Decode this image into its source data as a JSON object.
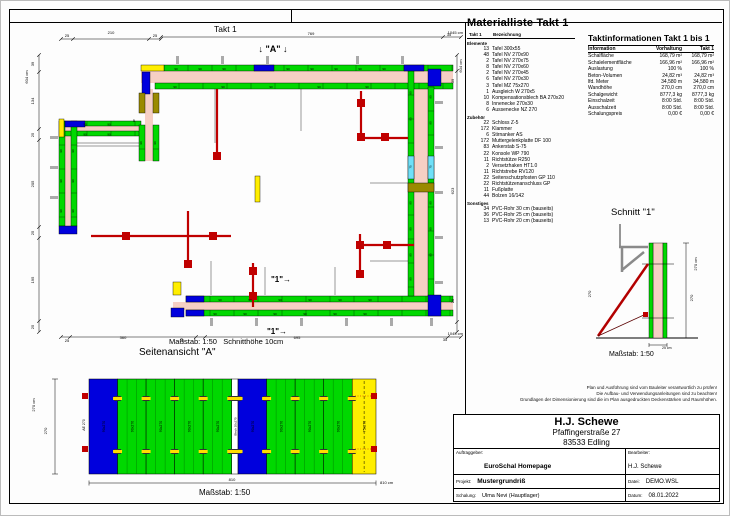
{
  "sheet": {
    "takt_label": "Takt 1"
  },
  "plan": {
    "masstab": "Maßstab: 1:50",
    "schnitthoehe": "Schnitthöhe 10cm",
    "labels": [
      {
        "t": "25",
        "x": 42,
        "y": 6
      },
      {
        "t": "210",
        "x": 86,
        "y": 3
      },
      {
        "t": "25",
        "x": 130,
        "y": 6
      },
      {
        "t": "769",
        "x": 286,
        "y": 4
      },
      {
        "t": "35",
        "x": 424,
        "y": 5
      },
      {
        "t": "1045 cm",
        "x": 438,
        "y": 3,
        "a": "end"
      },
      {
        "t": "604 cm",
        "x": 3,
        "y": 46,
        "r": -90
      },
      {
        "t": "39",
        "x": 9,
        "y": 33,
        "r": -90
      },
      {
        "t": "134",
        "x": 9,
        "y": 70,
        "r": -90
      },
      {
        "t": "25",
        "x": 9,
        "y": 104,
        "r": -90
      },
      {
        "t": "205",
        "x": 9,
        "y": 153,
        "r": -90
      },
      {
        "t": "25",
        "x": 9,
        "y": 202,
        "r": -90
      },
      {
        "t": "195",
        "x": 9,
        "y": 249,
        "r": -90
      },
      {
        "t": "25",
        "x": 9,
        "y": 296,
        "r": -90
      },
      {
        "t": "604 cm",
        "x": 437,
        "y": 35,
        "r": -90
      },
      {
        "t": "39",
        "x": 429,
        "y": 50,
        "r": -90
      },
      {
        "t": "623",
        "x": 429,
        "y": 160,
        "r": -90
      },
      {
        "t": "25",
        "x": 429,
        "y": 270,
        "r": -90
      },
      {
        "t": "25",
        "x": 42,
        "y": 311
      },
      {
        "t": "360",
        "x": 98,
        "y": 308
      },
      {
        "t": "25",
        "x": 157,
        "y": 311
      },
      {
        "t": "695",
        "x": 272,
        "y": 308
      },
      {
        "t": "35",
        "x": 420,
        "y": 310
      },
      {
        "t": "1045 cm",
        "x": 438,
        "y": 304,
        "a": "end"
      },
      {
        "t": "5",
        "x": 109,
        "y": 91
      },
      {
        "t": "↓ \"A\" ↓",
        "x": 248,
        "y": 21,
        "s": 9,
        "b": 1
      },
      {
        "t": "\"1\"→",
        "x": 256,
        "y": 251,
        "s": 8,
        "b": 1
      },
      {
        "t": "\"1\"→",
        "x": 252,
        "y": 303,
        "s": 8,
        "b": 1
      },
      {
        "t": "90",
        "x": 151,
        "y": 38.8,
        "s": 3
      },
      {
        "t": "90",
        "x": 175,
        "y": 38.8,
        "s": 3
      },
      {
        "t": "90",
        "x": 199,
        "y": 38.8,
        "s": 3
      },
      {
        "t": "90",
        "x": 263,
        "y": 38.8,
        "s": 3
      },
      {
        "t": "90",
        "x": 287,
        "y": 38.8,
        "s": 3
      },
      {
        "t": "90",
        "x": 311,
        "y": 38.8,
        "s": 3
      },
      {
        "t": "90",
        "x": 335,
        "y": 38.8,
        "s": 3
      },
      {
        "t": "90",
        "x": 359,
        "y": 38.8,
        "s": 3
      },
      {
        "t": "90",
        "x": 150,
        "y": 56.8,
        "s": 3
      },
      {
        "t": "90",
        "x": 198,
        "y": 56.8,
        "s": 3
      },
      {
        "t": "90",
        "x": 246,
        "y": 56.8,
        "s": 3
      },
      {
        "t": "90",
        "x": 294,
        "y": 56.8,
        "s": 3
      },
      {
        "t": "90",
        "x": 342,
        "y": 56.8,
        "s": 3
      },
      {
        "t": "90",
        "x": 195,
        "y": 269.8,
        "s": 3
      },
      {
        "t": "90",
        "x": 225,
        "y": 269.8,
        "s": 3
      },
      {
        "t": "90",
        "x": 255,
        "y": 269.8,
        "s": 3
      },
      {
        "t": "90",
        "x": 285,
        "y": 269.8,
        "s": 3
      },
      {
        "t": "90",
        "x": 315,
        "y": 269.8,
        "s": 3
      },
      {
        "t": "90",
        "x": 345,
        "y": 269.8,
        "s": 3
      },
      {
        "t": "90",
        "x": 190,
        "y": 283.8,
        "s": 3
      },
      {
        "t": "90",
        "x": 220,
        "y": 283.8,
        "s": 3
      },
      {
        "t": "90",
        "x": 250,
        "y": 283.8,
        "s": 3
      },
      {
        "t": "90",
        "x": 280,
        "y": 283.8,
        "s": 3
      },
      {
        "t": "90",
        "x": 310,
        "y": 283.8,
        "s": 3
      },
      {
        "t": "90",
        "x": 340,
        "y": 283.8,
        "s": 3
      },
      {
        "t": "90",
        "x": 386.5,
        "y": 62,
        "r": -90,
        "s": 3
      },
      {
        "t": "90",
        "x": 386.5,
        "y": 88,
        "r": -90,
        "s": 3
      },
      {
        "t": "90",
        "x": 386.5,
        "y": 172,
        "r": -90,
        "s": 3
      },
      {
        "t": "90",
        "x": 386.5,
        "y": 198,
        "r": -90,
        "s": 3
      },
      {
        "t": "90",
        "x": 386.5,
        "y": 224,
        "r": -90,
        "s": 3
      },
      {
        "t": "90",
        "x": 386.5,
        "y": 248,
        "r": -90,
        "s": 3
      },
      {
        "t": "90",
        "x": 406.5,
        "y": 66,
        "r": -90,
        "s": 3
      },
      {
        "t": "90",
        "x": 406.5,
        "y": 92,
        "r": -90,
        "s": 3
      },
      {
        "t": "90",
        "x": 406.5,
        "y": 172,
        "r": -90,
        "s": 3
      },
      {
        "t": "90",
        "x": 406.5,
        "y": 198,
        "r": -90,
        "s": 3
      },
      {
        "t": "90",
        "x": 406.5,
        "y": 224,
        "r": -90,
        "s": 3
      },
      {
        "t": "75",
        "x": 386.5,
        "y": 136,
        "r": -90,
        "s": 3
      },
      {
        "t": "75",
        "x": 406.5,
        "y": 136,
        "r": -90,
        "s": 3
      },
      {
        "t": "90",
        "x": 117,
        "y": 112,
        "r": -90,
        "s": 3
      },
      {
        "t": "90",
        "x": 131,
        "y": 112,
        "r": -90,
        "s": 3
      },
      {
        "t": "90",
        "x": 60,
        "y": 94.5,
        "s": 3
      },
      {
        "t": "90",
        "x": 84,
        "y": 94.5,
        "s": 3
      },
      {
        "t": "90",
        "x": 60,
        "y": 104.5,
        "s": 3
      },
      {
        "t": "90",
        "x": 84,
        "y": 104.5,
        "s": 3
      },
      {
        "t": "90",
        "x": 37,
        "y": 120,
        "r": -90,
        "s": 3
      },
      {
        "t": "90",
        "x": 37,
        "y": 150,
        "r": -90,
        "s": 3
      },
      {
        "t": "90",
        "x": 37,
        "y": 180,
        "r": -90,
        "s": 3
      },
      {
        "t": "90",
        "x": 49,
        "y": 120,
        "r": -90,
        "s": 3
      },
      {
        "t": "90",
        "x": 49,
        "y": 150,
        "r": -90,
        "s": 3
      },
      {
        "t": "90",
        "x": 49,
        "y": 180,
        "r": -90,
        "s": 3
      }
    ]
  },
  "seitenansicht": {
    "title": "Seitenansicht \"A\"",
    "masstab": "Maßstab: 1:50",
    "panels": [
      {
        "color": "#0000dd",
        "label": "90x270",
        "w": 90
      },
      {
        "color": "#00d800",
        "label": "90x270",
        "w": 90
      },
      {
        "color": "#00d800",
        "label": "90x270",
        "w": 90
      },
      {
        "color": "#00d800",
        "label": "90x270",
        "w": 90
      },
      {
        "color": "#00d800",
        "label": "90x270",
        "w": 90
      },
      {
        "color": "#ffffff",
        "label": "Blech 20x270",
        "w": 20
      },
      {
        "color": "#0000dd",
        "label": "90x270",
        "w": 90
      },
      {
        "color": "#00d800",
        "label": "90x270",
        "w": 90
      },
      {
        "color": "#00d800",
        "label": "90x270",
        "w": 90
      },
      {
        "color": "#00d800",
        "label": "90x270",
        "w": 90
      },
      {
        "color": "#ffee00",
        "label": "75x270",
        "w": 75,
        "dashed": true
      }
    ],
    "labels": [
      {
        "t": "270 cm",
        "x": 10,
        "y": 52,
        "r": -90,
        "s": 4
      },
      {
        "t": "270",
        "x": 22,
        "y": 78,
        "r": -90,
        "s": 4
      },
      {
        "t": "AE 270",
        "x": 60,
        "y": 72,
        "r": -90,
        "s": 3.5
      },
      {
        "t": "810",
        "x": 207,
        "y": 128,
        "s": 4
      },
      {
        "t": "810 cm",
        "x": 355,
        "y": 131,
        "a": "start",
        "s": 4
      }
    ]
  },
  "schnitt": {
    "title": "Schnitt \"1\"",
    "masstab": "Maßstab: 1:50",
    "labels": [
      {
        "t": "270 cm",
        "x": 111,
        "y": 58,
        "r": -90,
        "s": 4
      },
      {
        "t": "270",
        "x": 107,
        "y": 92,
        "r": -90,
        "s": 4
      },
      {
        "t": "270",
        "x": 5,
        "y": 88,
        "r": -90,
        "s": 4
      },
      {
        "t": "25 cm",
        "x": 76,
        "y": 143,
        "s": 3.5,
        "a": "start"
      }
    ]
  },
  "materialliste": {
    "title": "Materialliste  Takt 1",
    "col_qty": "Takt 1",
    "col_name": "Bezeichnung",
    "groups": [
      {
        "name": "Elemente",
        "items": [
          [
            "13",
            "Tafel 300x55"
          ],
          [
            "48",
            "Tafel NV 270x90"
          ],
          [
            "2",
            "Tafel NV 270x75"
          ],
          [
            "8",
            "Tafel NV 270x60"
          ],
          [
            "2",
            "Tafel NV 270x45"
          ],
          [
            "6",
            "Tafel NV 270x30"
          ],
          [
            "3",
            "Tafel MZ 75x270"
          ],
          [
            "1",
            "Ausgleich W 270x5"
          ],
          [
            "10",
            "Kompensationsblech BA 270x20"
          ],
          [
            "8",
            "Innenecke 270x30"
          ],
          [
            "6",
            "Aussenecke NZ 270"
          ]
        ]
      },
      {
        "name": "Zubehör",
        "items": [
          [
            "22",
            "Schloss Z-5"
          ],
          [
            "172",
            "Klammer"
          ],
          [
            "6",
            "Stirnanker AS"
          ],
          [
            "172",
            "Muttergelenkplatte DF 100"
          ],
          [
            "83",
            "Ankerstab S-75"
          ],
          [
            "22",
            "Konsole WP 790"
          ],
          [
            "11",
            "Richtstütze R250"
          ],
          [
            "2",
            "Versetzhaken HT1.0"
          ],
          [
            "11",
            "Richtstrebe RV120"
          ],
          [
            "22",
            "Seitenschutzpfosten GP 110"
          ],
          [
            "22",
            "Richtstützenanschluss GP"
          ],
          [
            "11",
            "Fußplatte"
          ],
          [
            "44",
            "Bolzen 16/142"
          ]
        ]
      },
      {
        "name": "Sonstiges",
        "items": [
          [
            "34",
            "PVC-Rohr 30 cm (bauseits)"
          ],
          [
            "36",
            "PVC-Rohr 25 cm (bauseits)"
          ],
          [
            "13",
            "PVC-Rohr 20 cm (bauseits)"
          ]
        ]
      }
    ]
  },
  "taktinfo": {
    "title": "Taktinformationen  Takt 1 bis 1",
    "columns": [
      "Information",
      "Vorhaltung",
      "Takt 1"
    ],
    "rows": [
      [
        "Schalfläche",
        "168,79 m²",
        "168,79 m²"
      ],
      [
        "Schalelementfläche",
        "166,96 m²",
        "166,96 m²"
      ],
      [
        "Auslastung",
        "100 %",
        "100 %"
      ],
      [
        "Beton-Volumen",
        "24,82 m³",
        "24,82 m³"
      ],
      [
        "lfd. Meter",
        "34,580 m",
        "34,580 m"
      ],
      [
        "Wandhöhe",
        "270,0 cm",
        "270,0 cm"
      ],
      [
        "Schalgewicht",
        "8777,3 kg",
        "8777,3 kg"
      ],
      [
        "Einschalzeit",
        "8:00 Std.",
        "8:00 Std."
      ],
      [
        "Ausschalzeit",
        "8:00 Std.",
        "8:00 Std."
      ],
      [
        "Schalungspreis",
        "0,00 €",
        "0,00 €"
      ]
    ]
  },
  "disclaimer": [
    "Plan und Ausführung sind vom Bauleiter verantwortlich zu prüfen!",
    "Die Aufbau- und Verwendungsanleitungen sind zu beachten!",
    "Grundlagen der Dimensionierung sind die im Plan ausgedruckten Deckenstärken und Raumhöhen."
  ],
  "titleblock": {
    "company": "H.J. Schewe",
    "street": "Pfaffingerstraße 27",
    "city": "83533 Edling",
    "auftraggeber_label": "Auftraggeber:",
    "auftraggeber": "EuroSchal Homepage",
    "bearbeiter_label": "Bearbeiter:",
    "bearbeiter": "H.J. Schewe",
    "projekt_label": "Projekt:",
    "projekt": "Mustergrundriß",
    "datei_label": "Datei:",
    "datei": "DEMO.WSL",
    "schalung_label": "Schalung:",
    "schalung": "Ulma Nevi (Hauptlager)",
    "datum_label": "Datum:",
    "datum": "08.01.2022"
  },
  "colors": {
    "panel_green": "#00d800",
    "panel_blue": "#0000dd",
    "panel_yellow": "#ffee00",
    "wall_pink": "#f6cfc4",
    "panel_cyan": "#6fe0f8",
    "corner_olive": "#9a8a00",
    "brace_red": "#c00000"
  }
}
